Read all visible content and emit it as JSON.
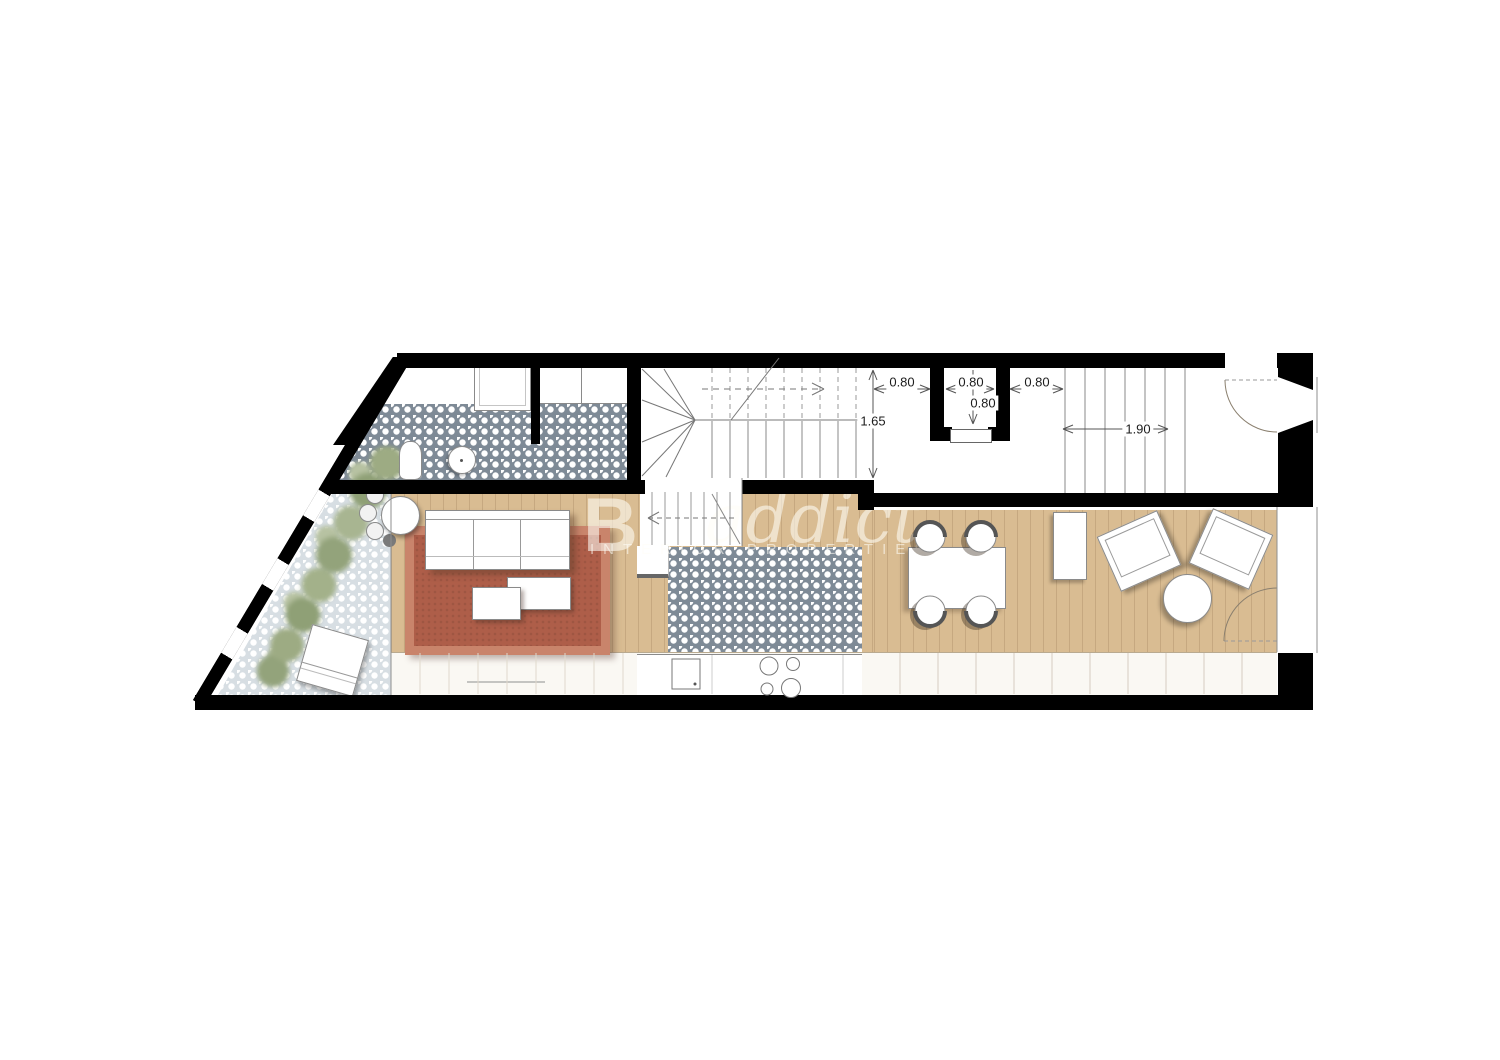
{
  "plan": {
    "dimensions": {
      "left_of_shaft": "0.80",
      "shaft_width": "0.80",
      "right_of_shaft": "0.80",
      "shaft_depth": "0.80",
      "hall_depth": "1.65",
      "stair_width": "1.90"
    },
    "watermark": {
      "initial": "B",
      "script": "addict",
      "subtitle": "INTERIOR PROPERTIES"
    },
    "colors": {
      "wall": "#000000",
      "wood_floor": "#d9bc92",
      "tile_dark": "#7e8a96",
      "tile_light": "#c7d1d8",
      "rug_field": "#ae5e49",
      "rug_border": "#c9846b",
      "plants": "#9dab83"
    }
  }
}
